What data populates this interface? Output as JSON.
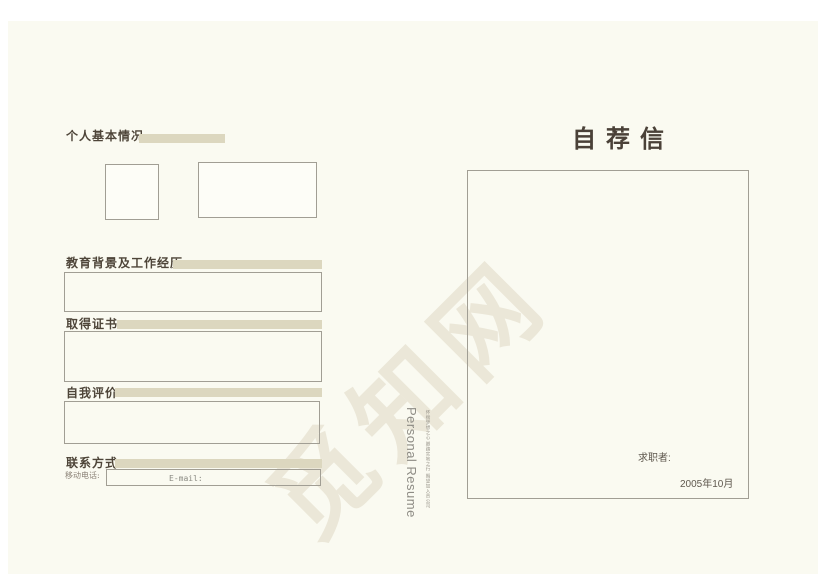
{
  "watermark_text": "觅知网",
  "left": {
    "sections": [
      {
        "title": "个人基本情况"
      },
      {
        "title": "教育背景及工作经历"
      },
      {
        "title": "取得证书"
      },
      {
        "title": "自我评价"
      },
      {
        "title": "联系方式"
      }
    ],
    "contact": {
      "mobile_label": "移动电话:",
      "email_label": "E-mail:"
    }
  },
  "spine": {
    "title_en": "Personal Resume",
    "tagline": "怀揣梦想之心 脚踏实地之行 期望加入贵公司"
  },
  "right": {
    "title": "自荐信",
    "applicant_label": "求职者:",
    "date": "2005年10月"
  },
  "colors": {
    "page_bg": "#fafaf1",
    "accent_bar": "#dcd7bf",
    "heading_text": "#4e4539",
    "title_text": "#4a4138",
    "box_border": "#a19e94",
    "watermark": "#ebe7d8"
  }
}
